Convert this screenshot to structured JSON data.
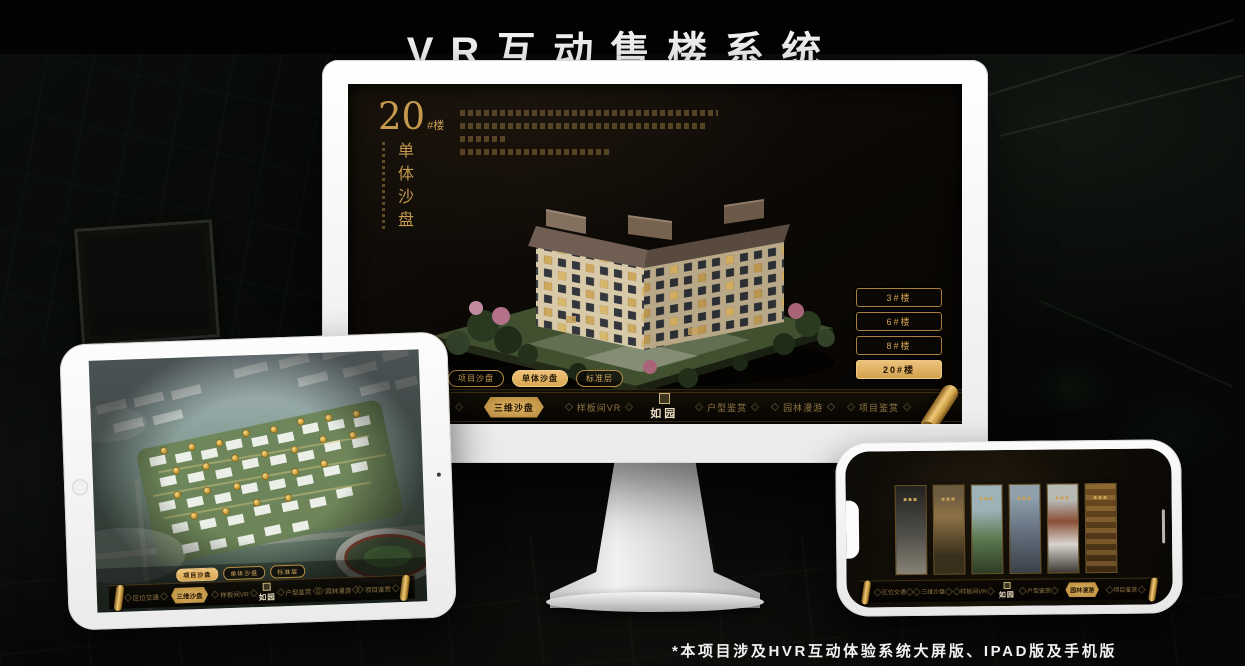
{
  "page": {
    "title": "VR互动售楼系统",
    "footnote": "*本项目涉及HVR互动体验系统大屏版、IPAD版及手机版"
  },
  "colors": {
    "gold": "#cfa254",
    "gold_bright": "#e9c173",
    "screen_bg": "#0d0a07",
    "device_white": "#f6f6f5"
  },
  "monitor": {
    "screen": {
      "block_number": "20",
      "block_suffix": "#楼",
      "vertical_title": "单体沙盘",
      "building_buttons": [
        {
          "label": "3#楼",
          "active": false
        },
        {
          "label": "6#楼",
          "active": false
        },
        {
          "label": "8#楼",
          "active": false
        },
        {
          "label": "20#楼",
          "active": true
        }
      ],
      "subtabs": [
        {
          "label": "项目沙盘",
          "active": false
        },
        {
          "label": "单体沙盘",
          "active": true
        },
        {
          "label": "标准层",
          "active": false
        }
      ],
      "nav": {
        "logo": "如园",
        "items": [
          {
            "label": "区位交通",
            "active": false
          },
          {
            "label": "三维沙盘",
            "active": true
          },
          {
            "label": "样板间VR",
            "active": false
          },
          {
            "label": "户型鉴赏",
            "active": false
          },
          {
            "label": "园林漫游",
            "active": false
          },
          {
            "label": "项目鉴赏",
            "active": false
          }
        ]
      }
    }
  },
  "tablet": {
    "subtabs": [
      {
        "label": "项目沙盘",
        "active": true
      },
      {
        "label": "单体沙盘",
        "active": false
      },
      {
        "label": "标准层",
        "active": false
      }
    ],
    "nav": {
      "logo": "如园",
      "items": [
        {
          "label": "区位交通",
          "active": false
        },
        {
          "label": "三维沙盘",
          "active": true
        },
        {
          "label": "样板间VR",
          "active": false
        },
        {
          "label": "户型鉴赏",
          "active": false
        },
        {
          "label": "园林漫游",
          "active": false
        },
        {
          "label": "项目鉴赏",
          "active": false
        }
      ]
    }
  },
  "phone": {
    "nav": {
      "logo": "如园",
      "items": [
        {
          "label": "区位交通",
          "active": false
        },
        {
          "label": "三维沙盘",
          "active": false
        },
        {
          "label": "样板间VR",
          "active": false
        },
        {
          "label": "户型鉴赏",
          "active": false
        },
        {
          "label": "园林漫游",
          "active": true
        },
        {
          "label": "项目鉴赏",
          "active": false
        }
      ]
    }
  }
}
